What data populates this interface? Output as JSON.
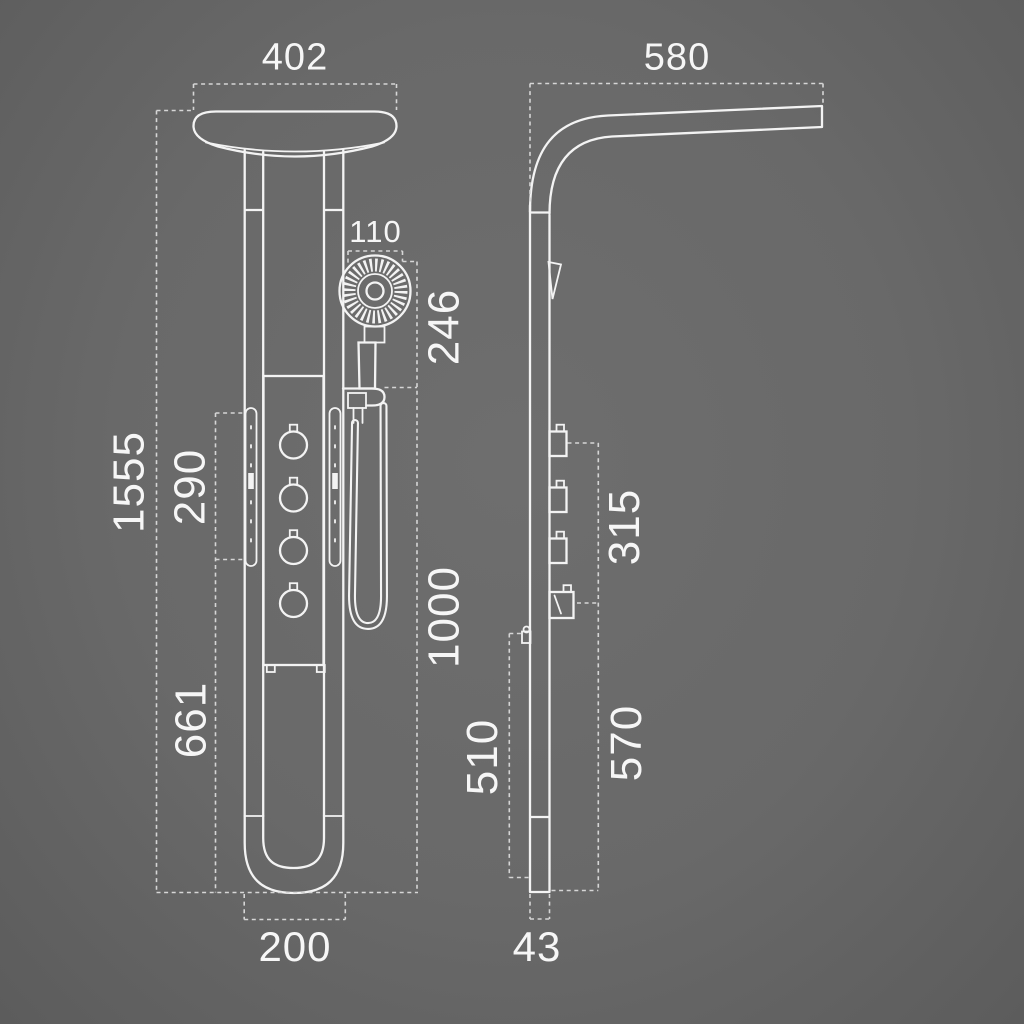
{
  "colors": {
    "background": "#696969",
    "line": "#f3f3f3",
    "dashed_dimension": "#d6d6d6",
    "text": "#f6f6f6"
  },
  "front_view": {
    "dimensions": {
      "head_width": "402",
      "hand_shower_width": "110",
      "hand_shower_height": "246",
      "total_height": "1555",
      "jet_panel_height": "290",
      "lower_section_height": "661",
      "hose_section_height": "1000",
      "base_width": "200"
    }
  },
  "side_view": {
    "dimensions": {
      "arm_projection": "580",
      "valve_section_height": "315",
      "diverter_to_base_height": "570",
      "holder_to_base_height": "510",
      "profile_depth": "43"
    }
  }
}
